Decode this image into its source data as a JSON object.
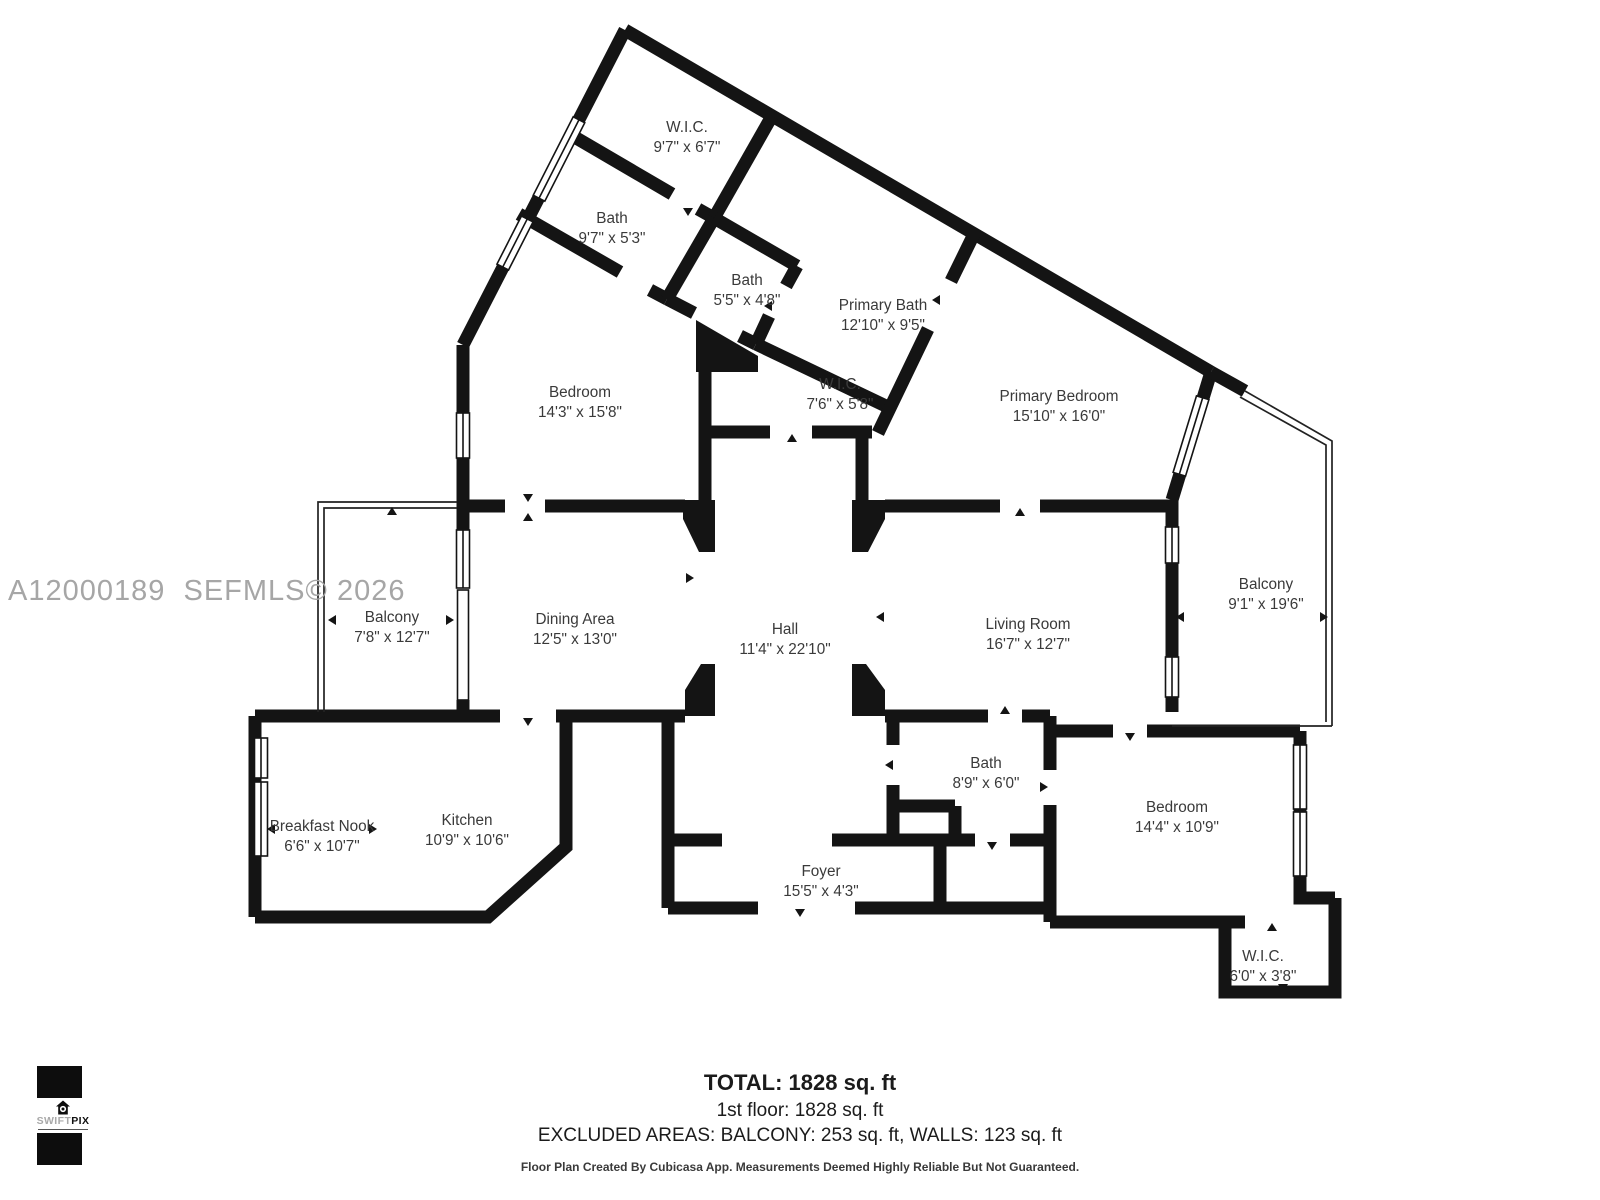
{
  "watermark": {
    "text": "A12000189  SEFMLS© 2026"
  },
  "logo": {
    "light": "SWIFT",
    "bold": "PIX"
  },
  "rooms": [
    {
      "name": "W.I.C.",
      "dims": "9'7\" x 6'7\""
    },
    {
      "name": "Bath",
      "dims": "9'7\" x 5'3\""
    },
    {
      "name": "Bath",
      "dims": "5'5\" x 4'8\""
    },
    {
      "name": "Primary Bath",
      "dims": "12'10\" x 9'5\""
    },
    {
      "name": "Bedroom",
      "dims": "14'3\" x 15'8\""
    },
    {
      "name": "W.I.C.",
      "dims": "7'6\" x 5'8\""
    },
    {
      "name": "Primary Bedroom",
      "dims": "15'10\" x 16'0\""
    },
    {
      "name": "Balcony",
      "dims": "7'8\" x 12'7\""
    },
    {
      "name": "Dining Area",
      "dims": "12'5\" x 13'0\""
    },
    {
      "name": "Hall",
      "dims": "11'4\" x 22'10\""
    },
    {
      "name": "Living Room",
      "dims": "16'7\" x 12'7\""
    },
    {
      "name": "Balcony",
      "dims": "9'1\" x 19'6\""
    },
    {
      "name": "Breakfast Nook",
      "dims": "6'6\" x 10'7\""
    },
    {
      "name": "Kitchen",
      "dims": "10'9\" x 10'6\""
    },
    {
      "name": "Bath",
      "dims": "8'9\" x 6'0\""
    },
    {
      "name": "Bedroom",
      "dims": "14'4\" x 10'9\""
    },
    {
      "name": "Foyer",
      "dims": "15'5\" x 4'3\""
    },
    {
      "name": "W.I.C.",
      "dims": "6'0\" x 3'8\""
    }
  ],
  "summary": {
    "total": "TOTAL: 1828 sq. ft",
    "first_floor": "1st floor: 1828 sq. ft",
    "excluded": "EXCLUDED AREAS: BALCONY: 253 sq. ft, WALLS: 123 sq. ft",
    "disclaimer": "Floor Plan Created By Cubicasa App. Measurements Deemed Highly Reliable But Not Guaranteed."
  },
  "colors": {
    "wall": "#141414",
    "label": "#3a3a3a",
    "watermark": "#a6a6a6"
  }
}
